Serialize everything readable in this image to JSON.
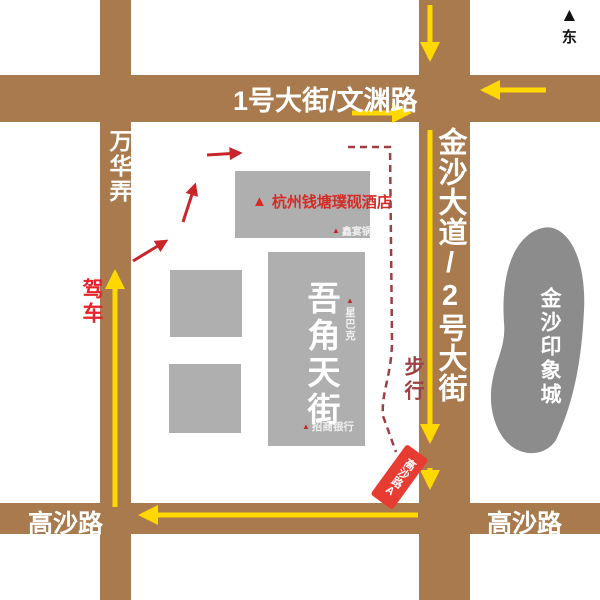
{
  "compass": {
    "label": "东"
  },
  "roads": {
    "wanhua_lane": "万华弄",
    "no1_avenue": "1号大街/文渊路",
    "jinsha_avenue": "金沙大道/2号大街",
    "gaosha_road_left": "高沙路",
    "gaosha_road_right": "高沙路"
  },
  "places": {
    "hotel": "杭州钱塘璞砚酒店",
    "mall": "吾角天街",
    "impression_city": "金沙印象城",
    "hotpot": "鑫宴锅",
    "starbucks": "星巴克",
    "bank": "招商银行",
    "metro_exit": "高沙路A"
  },
  "routes": {
    "driving": "驾车",
    "walking": "步行"
  },
  "colors": {
    "road": "#A87A4D",
    "route_yellow": "#FFD800",
    "driving_red": "#C9252B",
    "walking_maroon": "#9C4044",
    "building_gray": "#AFAFAF",
    "landmark_gray": "#8C8C8C",
    "metro_red": "#E63C32",
    "hotel_red": "#D42B27"
  }
}
